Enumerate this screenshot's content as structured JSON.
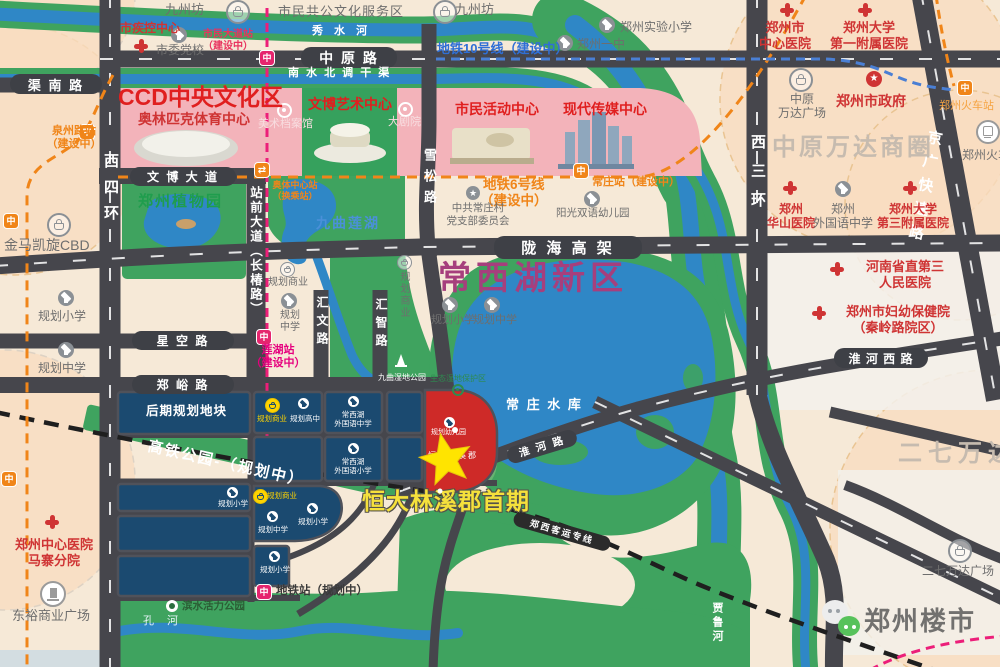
{
  "meta": {
    "title": "郑州常西湖新区 恒大林溪郡 区位图"
  },
  "colors": {
    "red": "#cf3434",
    "orange": "#f08519",
    "metro_pink": "#e5256e",
    "metro_blue": "#4a7fd4",
    "purple": "#a63f7d",
    "yellow_star": "#ffe400",
    "navy_block": "#1b4a70",
    "park_green": "#3fa35f",
    "water_blue": "#2f87c6",
    "ccd_pink": "#f3b3ba"
  },
  "top": {
    "jiuzhoufang_left": "九州坊",
    "civic_service": "市民共公文化服务区",
    "jiuzhoufang_right": "九州坊",
    "cdc": "市疾控中心",
    "party_school": "市委党校",
    "station_shimin": "市民大道站\n（建设中）",
    "xiushui_river": "秀 水 河",
    "zhongyuan_rd": "中 原 路",
    "nanshuibeidiao": "南 水 北 调 干 渠",
    "qunan_rd": "渠 南 路",
    "line10": "地铁10号线（建设中）",
    "shiyan_primary": "郑州实验小学",
    "no1_middle": "郑州一中",
    "hosp_center": "郑州市\n中心医院",
    "hosp_zhengda1": "郑州大学\n第一附属医院",
    "city_gov": "郑州市政府",
    "wanda_plaza": "中原\n万达广场",
    "railway_station_metro": "郑州火车站",
    "railway_station": "郑州火车站",
    "wanda_circle": "中原万达商圈",
    "xisanhuan": "西三环",
    "jingguang": "京广快速路"
  },
  "ccd": {
    "title": "CCD中央文化区",
    "olympic": "奥林匹克体育中心",
    "wenbo_art": "文博艺术中心",
    "art_archive": "美术档案馆",
    "grand_theater": "大剧院",
    "civic_activity": "市民活动中心",
    "media_center": "现代传媒中心",
    "wenbo_ave": "文 博 大 道",
    "line6": "地铁6号线\n（建设中）",
    "station_changzhuang": "常庄站（建设中）",
    "yangguang_kg": "阳光双语幼儿园",
    "party_branch": "中共常庄村\n党支部委员会"
  },
  "west": {
    "quanzhou_station": "泉州路站\n（建设中）",
    "jinma_cbd": "金马凯旋CBD",
    "xisihuan": "西四环",
    "botanic_garden": "郑州植物园",
    "zhanqian_ave": "站前大道（长椿路）",
    "aoti_station": "奥体中心站\n（换乘站）",
    "plan_primary_w": "规划小学",
    "plan_middle_w": "规划中学",
    "xingkong_rd": "星 空 路",
    "zhengyu_rd": "郑 峪 路",
    "biz_h": "规划商业",
    "middle_c": "规划\n中学",
    "huiwen_rd": "汇文路",
    "huizhi_rd": "汇智路",
    "lianhu_station": "莲湖站\n（建设中）",
    "biz_v": "规划商业"
  },
  "center": {
    "xuesong_rd": "雪松路",
    "jiuqu_lake": "九曲莲湖",
    "longhai": "陇 海 高 架",
    "cxh_district": "常西湖新区",
    "plan_primary_c": "规划小学",
    "plan_middle_c": "规划中学",
    "wetland_park": "九曲湿地公园",
    "eco_zone": "生态湿地保护区",
    "reservoir": "常 庄 水 库",
    "huaihe_rd": "淮 河 路",
    "gaotie_park": "高铁公园-（规划中）"
  },
  "east": {
    "huashan_hosp": "郑州\n华山医院",
    "foreign_middle": "郑州\n外国语中学",
    "zhengda3_hosp": "郑州大学\n第三附属医院",
    "henan3_hosp": "河南省直第三\n人民医院",
    "fuyou_hosp": "郑州市妇幼保健院\n（秦岭路院区）",
    "huaihe_w_rd": "淮 河 西 路",
    "erqi_circle": "二七万达商圈",
    "erqi_plaza": "二七万达广场",
    "jialu_river": "贾鲁河",
    "zhengxi_railway": "郑西客运专线"
  },
  "blocks": {
    "houqi": "后期规划地块",
    "biz1": "规划商业",
    "high_school": "规划高中",
    "foreign_ms": "常西湖\n外国语中学",
    "foreign_ps": "常西湖\n外国语小学",
    "primary1": "规划小学",
    "biz2": "规划商业",
    "middle1": "规划中学",
    "primary2": "规划小学",
    "primary3": "规划小学",
    "kindergarten": "规划幼儿园",
    "hengda_name": "恒大林溪郡",
    "hengda_phase1": "恒大林溪郡首期"
  },
  "south": {
    "metro_plan_station": "地铁站（规划中）",
    "binshui_park": "滨水活力公园",
    "kong_river": "孔  河",
    "dongyu_plaza": "东裕商业广场",
    "mazhai_hosp": "郑州中心医院\n马寨分院"
  },
  "watermark": {
    "name": "郑州楼市"
  }
}
